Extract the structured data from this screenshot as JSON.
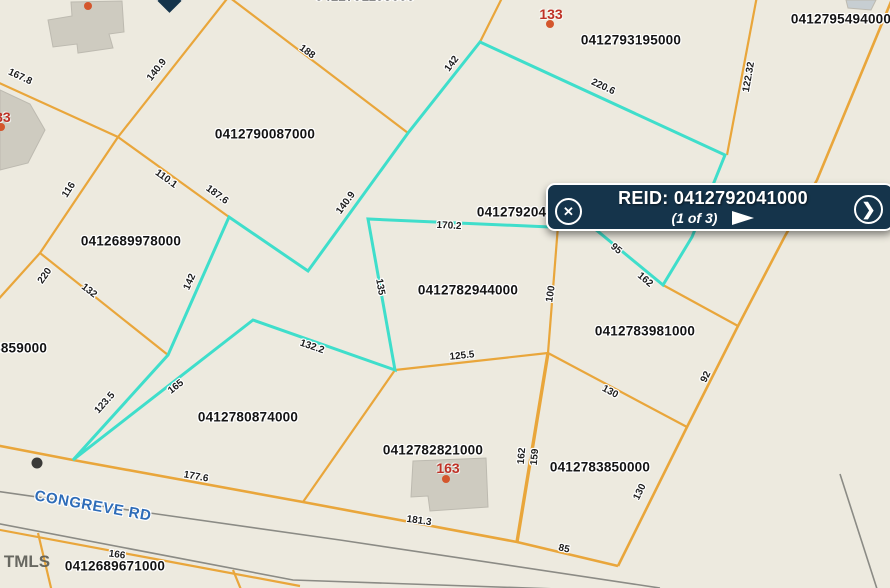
{
  "popup": {
    "title": "REID: 0412792041000",
    "pagination": "(1 of 3)",
    "close_icon": "x-circle",
    "next_icon": "chevron-right-circle",
    "play_icon": "triangle-right",
    "close_glyph": "✕",
    "next_glyph": "❯"
  },
  "map": {
    "background": "#edeadf",
    "road_label": {
      "text": "CONGREVE RD",
      "x": 93,
      "y": 506,
      "rot": 10
    },
    "watermark": {
      "text": "TMLS",
      "x": 27,
      "y": 562
    },
    "colors": {
      "parcel_line": "#e9a63b",
      "selected_outline": "#3fdecb",
      "road_line": "#8b8b85",
      "building_fill": "#cecbc0",
      "building_stroke": "#bdbab0",
      "address_dot": "#d4562c",
      "marker_dot": "#3a3a38",
      "popup_bg": "#15344b",
      "road_text": "#2e6cb8",
      "address_text": "#bf3126"
    },
    "selected_parcel_outline": [
      [
        480,
        42
      ],
      [
        408,
        133
      ],
      [
        308,
        271
      ],
      [
        229,
        217
      ],
      [
        168,
        355
      ],
      [
        73,
        460
      ],
      [
        253,
        320
      ],
      [
        395,
        370
      ],
      [
        368,
        219
      ],
      [
        595,
        229
      ],
      [
        663,
        285
      ],
      [
        692,
        237
      ],
      [
        725,
        155
      ]
    ],
    "parcel_lines": [
      {
        "points": [
          [
            -5,
            81
          ],
          [
            118,
            137
          ]
        ]
      },
      {
        "points": [
          [
            118,
            137
          ],
          [
            230,
            -5
          ]
        ]
      },
      {
        "points": [
          [
            225,
            -6
          ],
          [
            408,
            133
          ]
        ]
      },
      {
        "points": [
          [
            118,
            137
          ],
          [
            229,
            217
          ]
        ]
      },
      {
        "points": [
          [
            118,
            137
          ],
          [
            40,
            253
          ]
        ]
      },
      {
        "points": [
          [
            40,
            253
          ],
          [
            -5,
            303
          ]
        ]
      },
      {
        "points": [
          [
            40,
            253
          ],
          [
            168,
            355
          ]
        ]
      },
      {
        "points": [
          [
            560,
            200
          ],
          [
            548,
            353
          ]
        ]
      },
      {
        "points": [
          [
            395,
            370
          ],
          [
            548,
            353
          ]
        ]
      },
      {
        "points": [
          [
            548,
            353
          ],
          [
            687,
            427
          ]
        ]
      },
      {
        "points": [
          [
            548,
            353
          ],
          [
            517,
            542
          ]
        ],
        "w": 3.4
      },
      {
        "points": [
          [
            895,
            -8
          ],
          [
            817,
            180
          ],
          [
            785,
            236
          ],
          [
            738,
            326
          ],
          [
            687,
            427
          ],
          [
            618,
            566
          ]
        ],
        "w": 2.6
      },
      {
        "points": [
          [
            757,
            -4
          ],
          [
            727,
            155
          ]
        ]
      },
      {
        "points": [
          [
            663,
            285
          ],
          [
            738,
            326
          ]
        ]
      },
      {
        "points": [
          [
            -5,
            445
          ],
          [
            73,
            460
          ],
          [
            303,
            502
          ],
          [
            517,
            542
          ],
          [
            618,
            566
          ]
        ],
        "w": 2.6
      },
      {
        "points": [
          [
            395,
            370
          ],
          [
            303,
            502
          ]
        ]
      },
      {
        "points": [
          [
            -5,
            529
          ],
          [
            150,
            558
          ],
          [
            300,
            586
          ]
        ]
      },
      {
        "points": [
          [
            38,
            533
          ],
          [
            52,
            592
          ]
        ]
      },
      {
        "points": [
          [
            233,
            570
          ],
          [
            242,
            592
          ]
        ]
      },
      {
        "points": [
          [
            503,
            -4
          ],
          [
            480,
            42
          ]
        ]
      }
    ],
    "road_lines": [
      {
        "points": [
          [
            -5,
            491
          ],
          [
            340,
            540
          ],
          [
            660,
            588
          ]
        ]
      },
      {
        "points": [
          [
            -5,
            523
          ],
          [
            293,
            580
          ],
          [
            645,
            592
          ]
        ]
      },
      {
        "points": [
          [
            840,
            474
          ],
          [
            878,
            592
          ]
        ]
      }
    ],
    "buildings": [
      {
        "points": [
          [
            48,
            20
          ],
          [
            72,
            16
          ],
          [
            71,
            2
          ],
          [
            122,
            1
          ],
          [
            124,
            32
          ],
          [
            109,
            34
          ],
          [
            113,
            48
          ],
          [
            78,
            53
          ],
          [
            77,
            44
          ],
          [
            53,
            47
          ]
        ]
      },
      {
        "points": [
          [
            0,
            90
          ],
          [
            30,
            104
          ],
          [
            45,
            130
          ],
          [
            28,
            163
          ],
          [
            0,
            170
          ]
        ]
      },
      {
        "points": [
          [
            413,
            461
          ],
          [
            486,
            458
          ],
          [
            488,
            507
          ],
          [
            430,
            511
          ],
          [
            428,
            496
          ],
          [
            411,
            497
          ]
        ]
      },
      {
        "points": [
          [
            846,
            0
          ],
          [
            876,
            0
          ],
          [
            871,
            10
          ],
          [
            848,
            8
          ]
        ],
        "fill": "#c7ced2"
      }
    ],
    "address_dots": [
      {
        "x": 550,
        "y": 24
      },
      {
        "x": 446,
        "y": 479
      },
      {
        "x": 88,
        "y": 6
      },
      {
        "x": 1,
        "y": 127
      }
    ],
    "marker_dot": {
      "x": 37,
      "y": 463
    },
    "parcel_labels": [
      {
        "text": "0412790087000",
        "x": 265,
        "y": 134
      },
      {
        "text": "0412689978000",
        "x": 131,
        "y": 241
      },
      {
        "text": "0412793195000",
        "x": 631,
        "y": 40
      },
      {
        "text": "0412795494000",
        "x": 841,
        "y": 19
      },
      {
        "text": "0412792041000",
        "x": 527,
        "y": 212
      },
      {
        "text": "0412782944000",
        "x": 468,
        "y": 290
      },
      {
        "text": "0412783981000",
        "x": 645,
        "y": 331
      },
      {
        "text": "0412783850000",
        "x": 600,
        "y": 467
      },
      {
        "text": "0412780874000",
        "x": 248,
        "y": 417
      },
      {
        "text": "0412782821000",
        "x": 433,
        "y": 450
      },
      {
        "text": "0412689671000",
        "x": 115,
        "y": 566
      },
      {
        "text": "0412688859000",
        "x": -3,
        "y": 348
      },
      {
        "text": "0412791195000",
        "x": 365,
        "y": -4
      }
    ],
    "address_labels": [
      {
        "text": "133",
        "x": 551,
        "y": 14
      },
      {
        "text": "163",
        "x": 448,
        "y": 468
      },
      {
        "text": "133",
        "x": -1,
        "y": 117
      }
    ],
    "dimension_labels": [
      {
        "text": "167.8",
        "x": 20,
        "y": 77,
        "rot": 25
      },
      {
        "text": "140.9",
        "x": 157,
        "y": 70,
        "rot": -52
      },
      {
        "text": "188",
        "x": 307,
        "y": 52,
        "rot": 36
      },
      {
        "text": "116",
        "x": 69,
        "y": 190,
        "rot": -57
      },
      {
        "text": "110.1",
        "x": 166,
        "y": 179,
        "rot": 36
      },
      {
        "text": "187.6",
        "x": 217,
        "y": 195,
        "rot": 36
      },
      {
        "text": "220",
        "x": 45,
        "y": 276,
        "rot": -55
      },
      {
        "text": "132",
        "x": 89,
        "y": 291,
        "rot": 38
      },
      {
        "text": "142",
        "x": 190,
        "y": 282,
        "rot": -66
      },
      {
        "text": "123.5",
        "x": 105,
        "y": 403,
        "rot": -48
      },
      {
        "text": "165",
        "x": 176,
        "y": 387,
        "rot": -38
      },
      {
        "text": "132.2",
        "x": 312,
        "y": 347,
        "rot": 19
      },
      {
        "text": "135",
        "x": 380,
        "y": 287,
        "rot": 80
      },
      {
        "text": "142",
        "x": 452,
        "y": 64,
        "rot": -53
      },
      {
        "text": "140.9",
        "x": 346,
        "y": 203,
        "rot": -54
      },
      {
        "text": "220.6",
        "x": 603,
        "y": 87,
        "rot": 25
      },
      {
        "text": "122.32",
        "x": 749,
        "y": 77,
        "rot": -80
      },
      {
        "text": "170.2",
        "x": 449,
        "y": 226,
        "rot": 3
      },
      {
        "text": "100",
        "x": 551,
        "y": 294,
        "rot": -81
      },
      {
        "text": "95",
        "x": 616,
        "y": 249,
        "rot": 40
      },
      {
        "text": "162",
        "x": 645,
        "y": 280,
        "rot": 40
      },
      {
        "text": "125.5",
        "x": 462,
        "y": 356,
        "rot": -6
      },
      {
        "text": "92",
        "x": 706,
        "y": 377,
        "rot": -63
      },
      {
        "text": "130",
        "x": 610,
        "y": 392,
        "rot": 28
      },
      {
        "text": "162",
        "x": 522,
        "y": 456,
        "rot": -85
      },
      {
        "text": "159",
        "x": 535,
        "y": 457,
        "rot": -85
      },
      {
        "text": "130",
        "x": 640,
        "y": 492,
        "rot": -64
      },
      {
        "text": "85",
        "x": 564,
        "y": 549,
        "rot": 12
      },
      {
        "text": "177.6",
        "x": 196,
        "y": 477,
        "rot": 10
      },
      {
        "text": "181.3",
        "x": 419,
        "y": 521,
        "rot": 8
      },
      {
        "text": "166",
        "x": 117,
        "y": 555,
        "rot": 8
      }
    ]
  }
}
